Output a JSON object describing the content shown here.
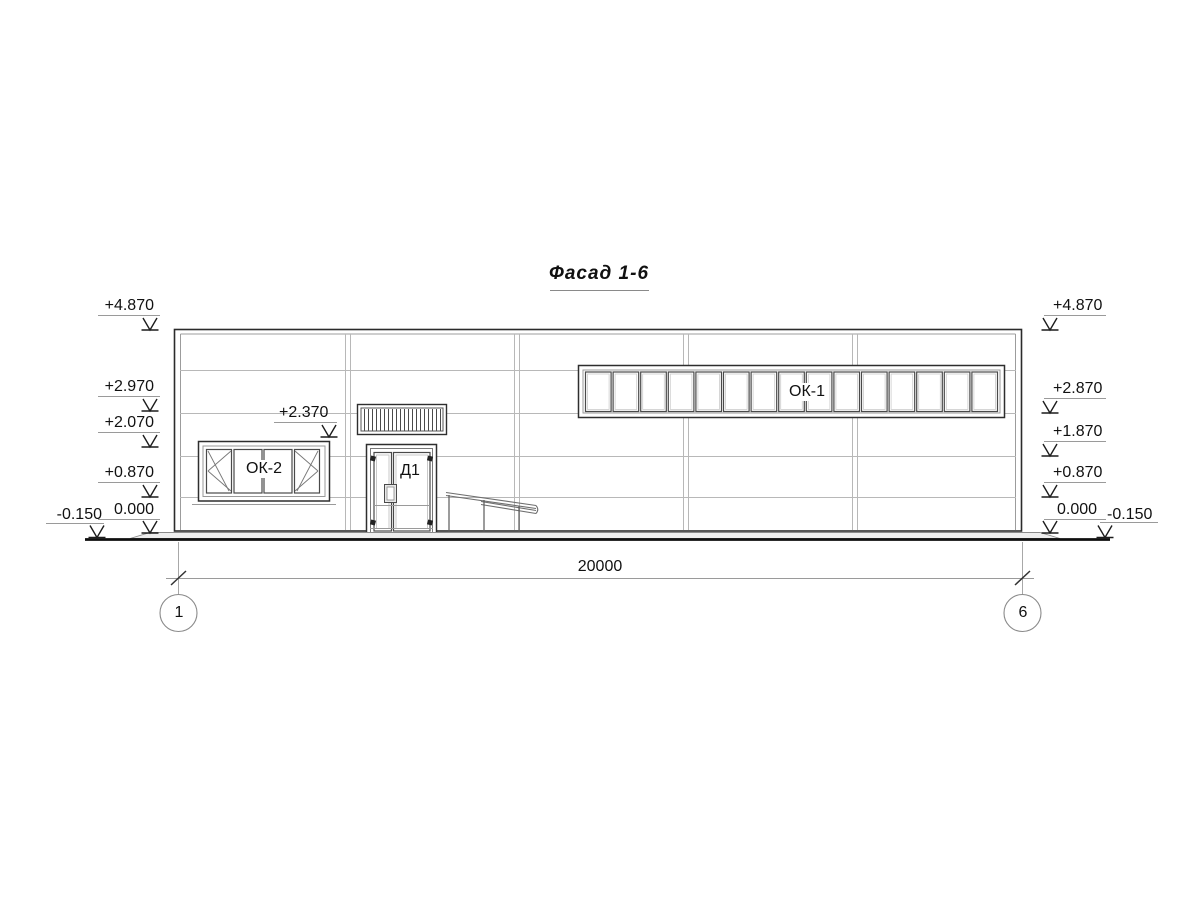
{
  "title": "Фасад 1-6",
  "elevations": {
    "left": [
      "+4.870",
      "+2.970",
      "+2.070",
      "+0.870",
      "0.000",
      "-0.150"
    ],
    "right": [
      "+4.870",
      "+2.870",
      "+1.870",
      "+0.870",
      "0.000",
      "-0.150"
    ],
    "door_head": "+2.370"
  },
  "component_labels": {
    "strip_window": "ОК-1",
    "left_window": "ОК-2",
    "entrance_door": "Д1"
  },
  "dimensions": {
    "overall_width": "20000"
  },
  "grid_axes": {
    "first": "1",
    "last": "6"
  },
  "geometry": {
    "ok1_pane_count": 15,
    "grille_slat_count": 20
  },
  "colors": {
    "line_dark": "#2b2b2b",
    "line_medium": "#666666",
    "line_light": "#b8b8b8",
    "ground": "#0f0f0f",
    "background": "#ffffff"
  }
}
